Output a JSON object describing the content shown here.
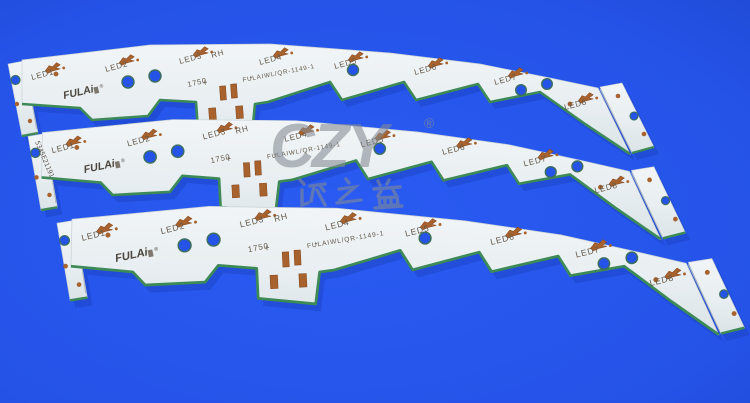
{
  "photo": {
    "background_color": "#2553e8",
    "watermark": {
      "logo": "CZY",
      "registered": "®",
      "chinese_text": "诚之益",
      "color": "#848b94"
    },
    "board": {
      "brand_logo": "FULAi",
      "brand_registered": "®",
      "led_labels": [
        "LED1",
        "LED2",
        "LED3",
        "LED4",
        "LED5",
        "LED6",
        "LED7",
        "LED8"
      ],
      "marking_rh": "RH",
      "marking_code": "1750",
      "part_number": "FULAIWL/QR-1149-1",
      "polarity_plus": "+",
      "polarity_minus": "-",
      "colors": {
        "surface": "#eaf0f2",
        "edge_green": "#3d8a57",
        "copper": "#a8622d",
        "silkscreen": "#645949",
        "hole_blue": "#2553e8"
      }
    },
    "strips": [
      {
        "position": "top"
      },
      {
        "position": "middle",
        "serial": "5345E21191"
      },
      {
        "position": "bottom"
      }
    ]
  }
}
